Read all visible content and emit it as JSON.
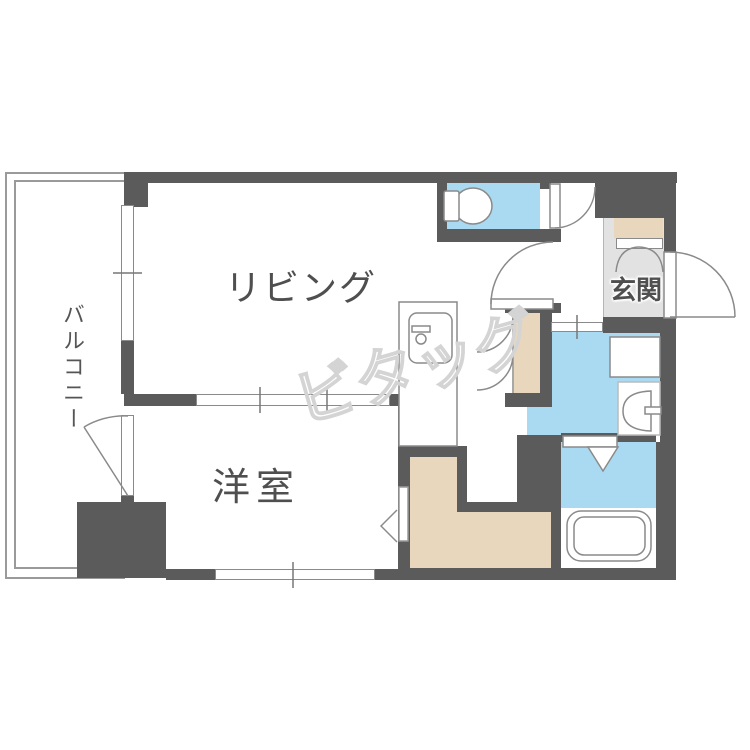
{
  "plan": {
    "type": "japanese-apartment-floorplan",
    "rooms": {
      "living": {
        "label": "リビング"
      },
      "western": {
        "label": "洋室"
      },
      "balcony": {
        "label": "バルコニー"
      },
      "entrance": {
        "label": "玄関"
      }
    },
    "watermark": "ビタッグ",
    "fixtures": [
      "toilet",
      "kitchen-sink",
      "washing-machine-pan",
      "washbasin",
      "bathtub",
      "shoe-cabinet",
      "walk-in-closet",
      "folding-door-closet",
      "entrance-door",
      "sliding-partition",
      "balcony-window"
    ],
    "colors": {
      "wall": "#5b5b5b",
      "wet-area-floor": "#aadaf2",
      "storage-floor": "#e9d7bd",
      "entrance-floor": "#e2e2e2",
      "outline": "#8a8a8a",
      "label-text": "#4f4f4f",
      "watermark": "#d4d4d4"
    }
  }
}
